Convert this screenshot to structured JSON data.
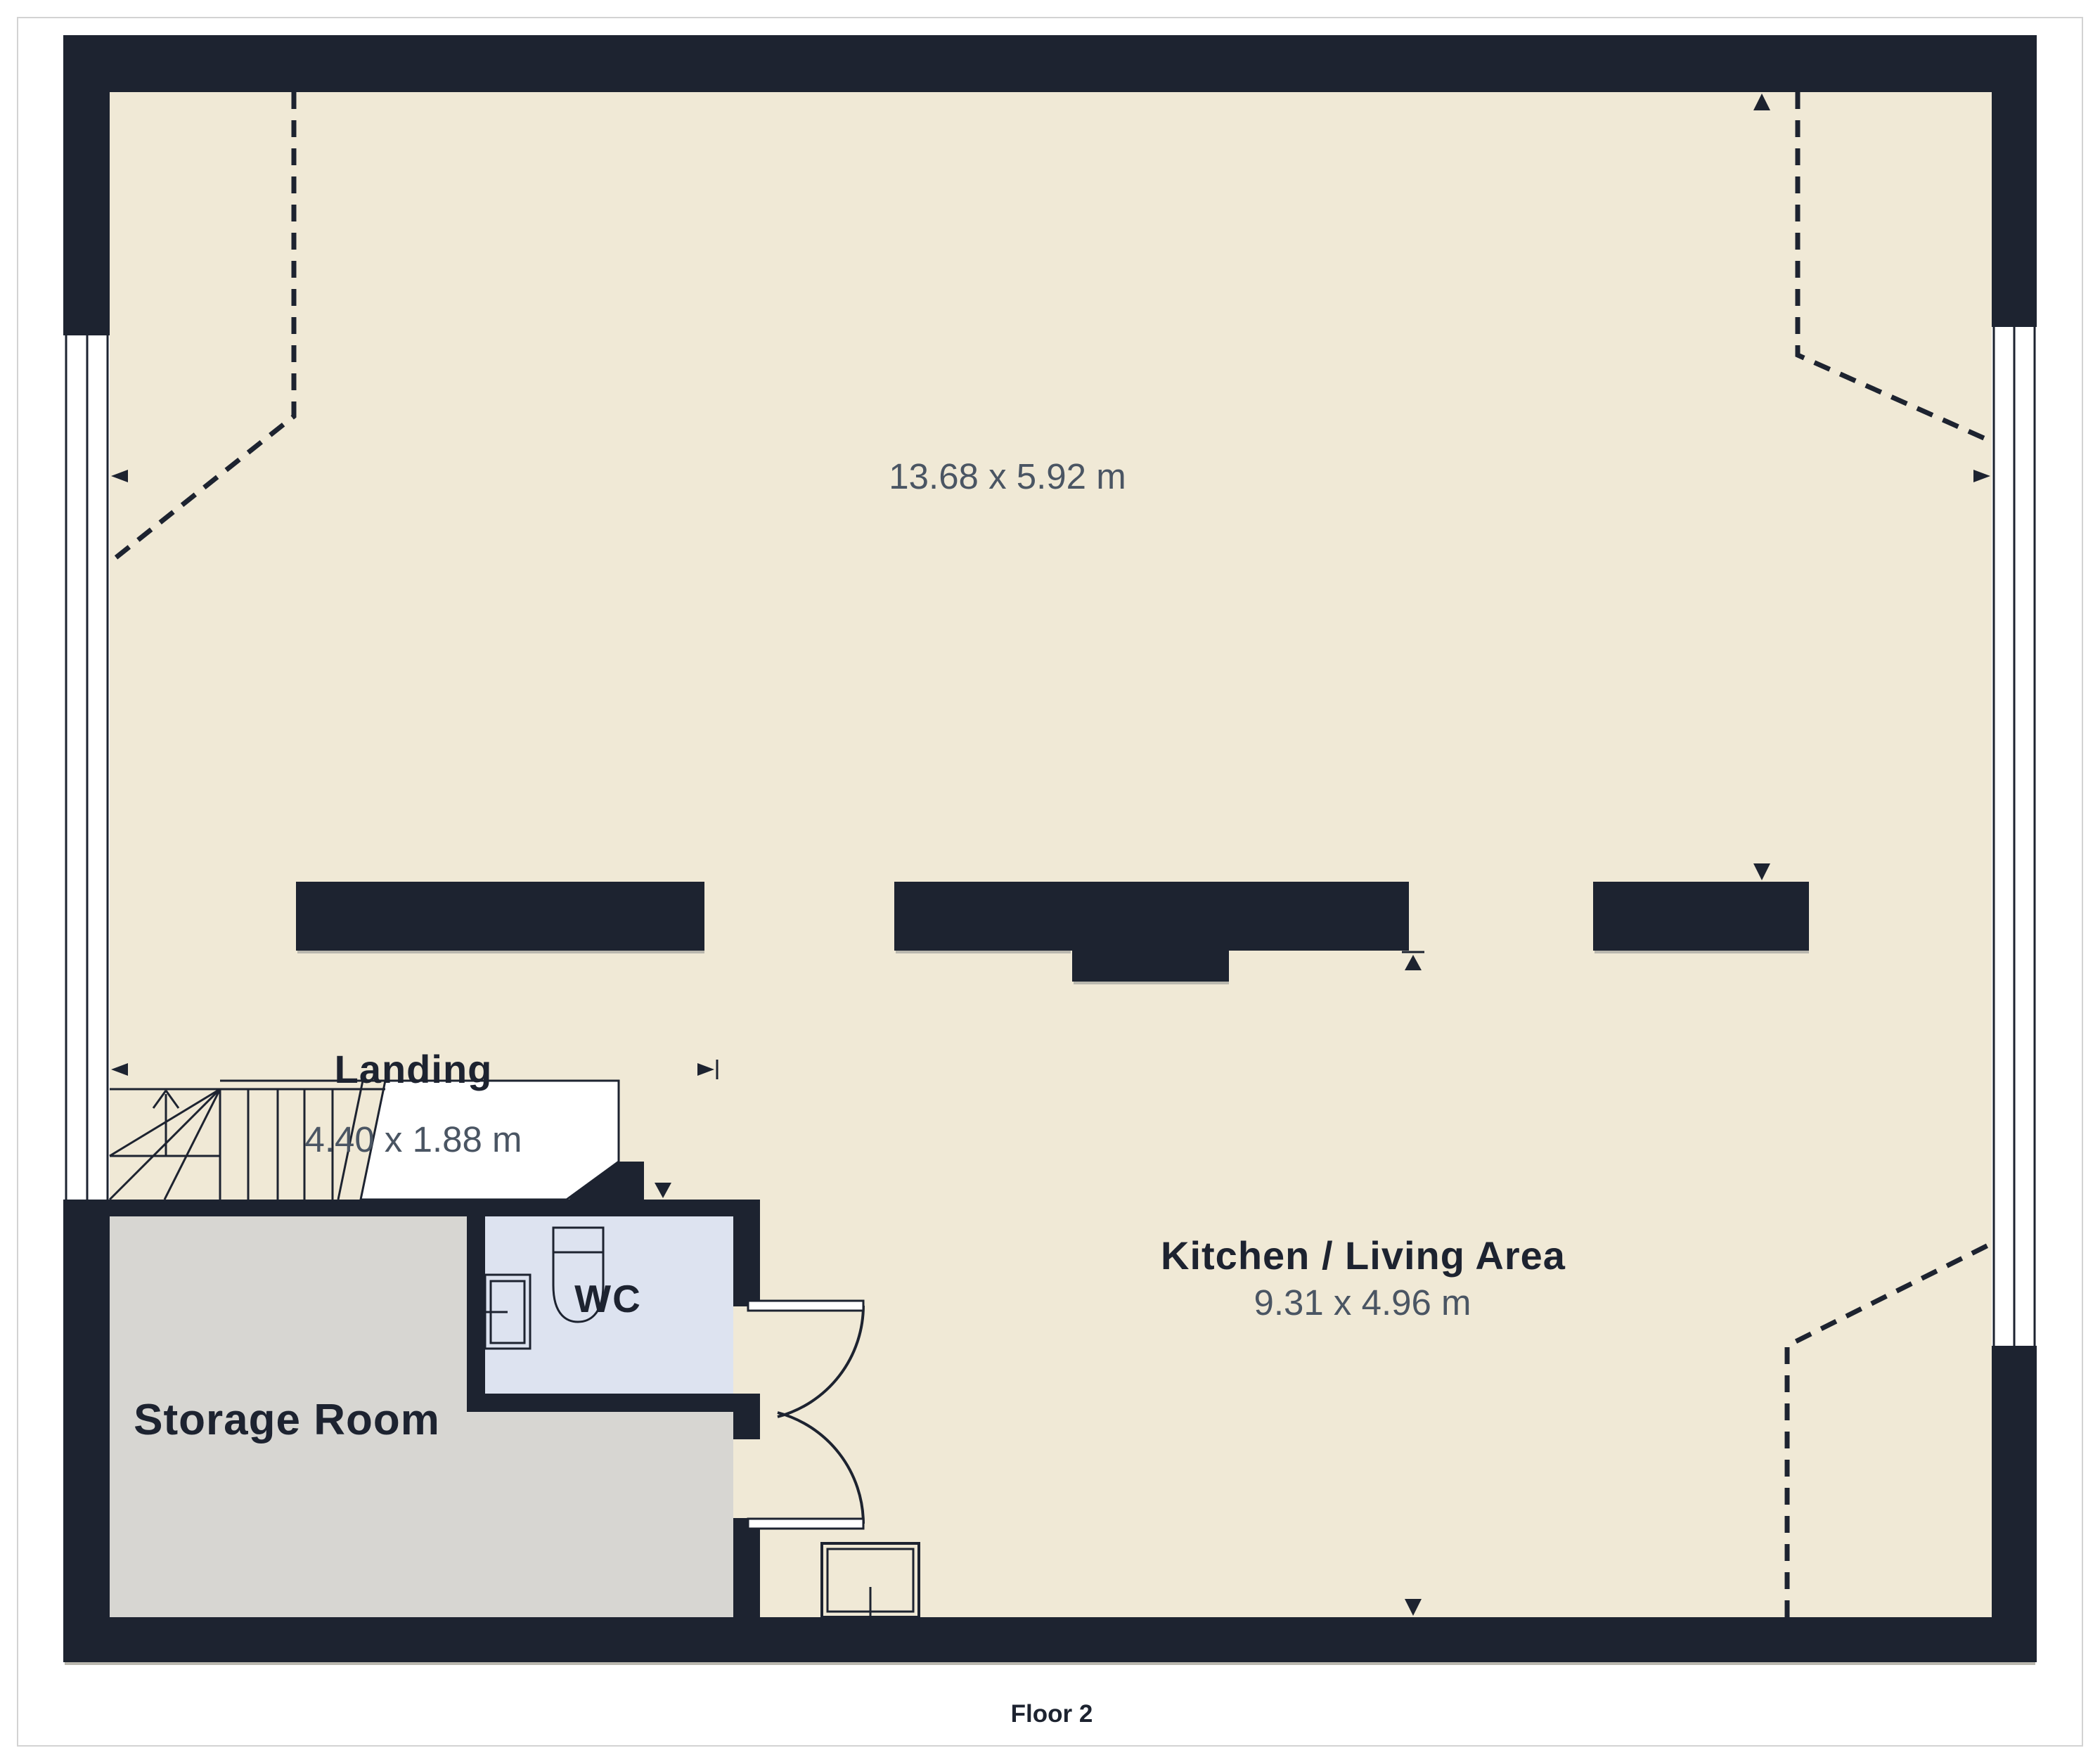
{
  "page": {
    "background": "#ffffff",
    "border_color": "#d3d3d3",
    "caption": "Floor 2"
  },
  "plan": {
    "colors": {
      "wall": "#1d2330",
      "floor": "#f0e9d6",
      "storage_floor": "#d7d6d2",
      "wc_floor": "#dde3f0",
      "window": "#ffffff",
      "dim_text": "#4a5563",
      "name_text": "#1d2330"
    },
    "rooms": [
      {
        "name": "",
        "dims": "13.68 x 5.92 m"
      },
      {
        "name": "Landing",
        "dims": "4.40 x 1.88 m"
      },
      {
        "name": "Kitchen / Living Area",
        "dims": "9.31 x 4.96 m"
      },
      {
        "name": "Storage Room",
        "dims": ""
      },
      {
        "name": "WC",
        "dims": ""
      }
    ]
  }
}
